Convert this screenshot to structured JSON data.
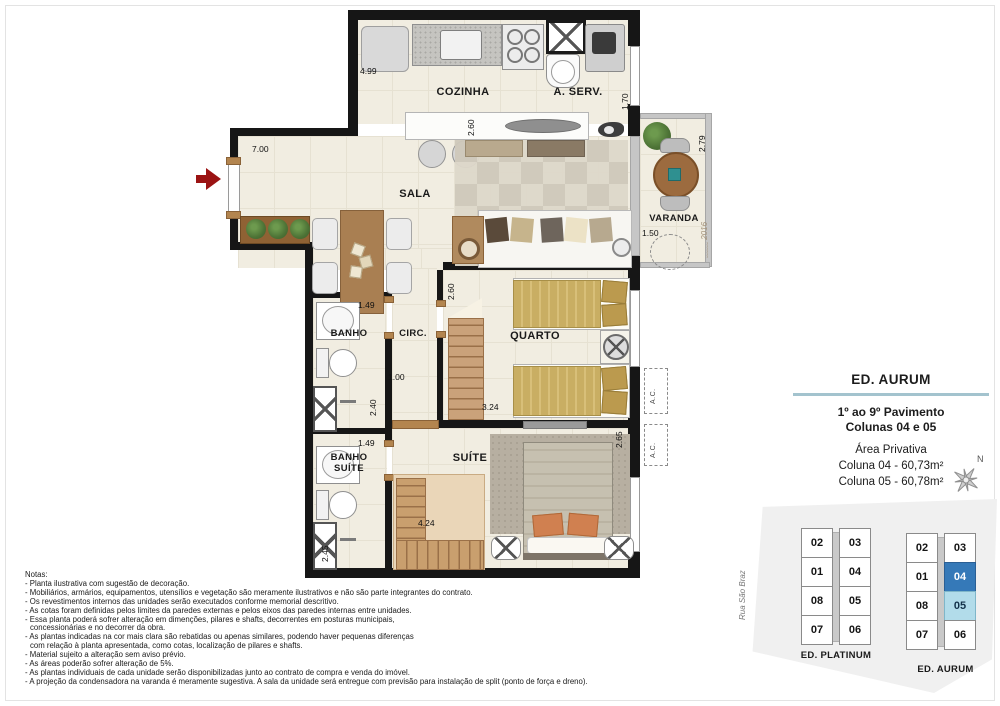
{
  "colors": {
    "wall": "#161616",
    "floor": "#f1ede1",
    "info_divider": "#a3c3ce",
    "unit_highlight_dark": "#3579b8",
    "unit_highlight_light": "#b2dcea",
    "entry_arrow": "#9b1313"
  },
  "plan": {
    "rooms": {
      "cozinha": "COZINHA",
      "aserv": "A. SERV.",
      "sala": "SALA",
      "varanda": "VARANDA",
      "banho": "BANHO",
      "circ": "CIRC.",
      "quarto": "QUARTO",
      "banho_suite": "BANHO SUÍTE",
      "suite": "SUÍTE",
      "ac": "A.C."
    },
    "dims": {
      "d_499": "4.99",
      "d_170": "1.70",
      "d_700": "7.00",
      "d_260a": "2.60",
      "d_279": "2.79",
      "d_150": "1.50",
      "d_260b": "2.60",
      "d_149a": "1.49",
      "d_100": "1.00",
      "d_240": "2.40",
      "d_324": "3.24",
      "d_149b": "1.49",
      "d_265": "2.65",
      "d_245": "2.45",
      "d_424": "4.24"
    },
    "signature": "2016"
  },
  "info_box": {
    "title": "ED. AURUM",
    "line1": "1º ao 9º Pavimento",
    "line2": "Colunas 04 e 05",
    "area_title": "Área Privativa",
    "col04": "Coluna 04 - 60,73m²",
    "col05": "Coluna 05 - 60,78m²",
    "compass_n": "N"
  },
  "key_plan": {
    "street": "Rua São Braz",
    "platinum": {
      "label": "ED. PLATINUM",
      "units": [
        "02",
        "03",
        "01",
        "04",
        "08",
        "05",
        "07",
        "06"
      ]
    },
    "aurum": {
      "label": "ED. AURUM",
      "units": [
        "02",
        "03",
        "01",
        "04",
        "08",
        "05",
        "07",
        "06"
      ],
      "highlight_dark": "04",
      "highlight_light": "05"
    }
  },
  "notes": {
    "title": "Notas:",
    "lines": [
      "- Planta ilustrativa com sugestão de decoração.",
      "- Mobiliários, armários, equipamentos, utensílios e vegetação são meramente ilustrativos e não são parte integrantes do contrato.",
      "- Os revestimentos internos das unidades serão executados conforme memorial descritivo.",
      "- As cotas foram definidas pelos limites da paredes externas e pelos eixos das paredes internas entre unidades.",
      "- Essa planta poderá sofrer alteração em dimenções, pilares e shafts, decorrentes em posturas municipais,",
      "concessionárias e no decorrer da obra.",
      "- As plantas indicadas na cor mais clara são rebatidas ou apenas similares, podendo haver pequenas diferenças",
      "com relação à planta apresentada, como cotas, localização de pilares e shafts.",
      "- Material sujeito a alteração sem aviso prévio.",
      "- As áreas poderão sofrer alteração de 5%.",
      "- As plantas individuais de cada unidade serão disponibilizadas junto ao contrato de compra e venda do imóvel.",
      "- A projeção da condensadora na varanda é meramente sugestiva. A sala da unidade será entregue com previsão para instalação de split (ponto de força e dreno)."
    ]
  }
}
